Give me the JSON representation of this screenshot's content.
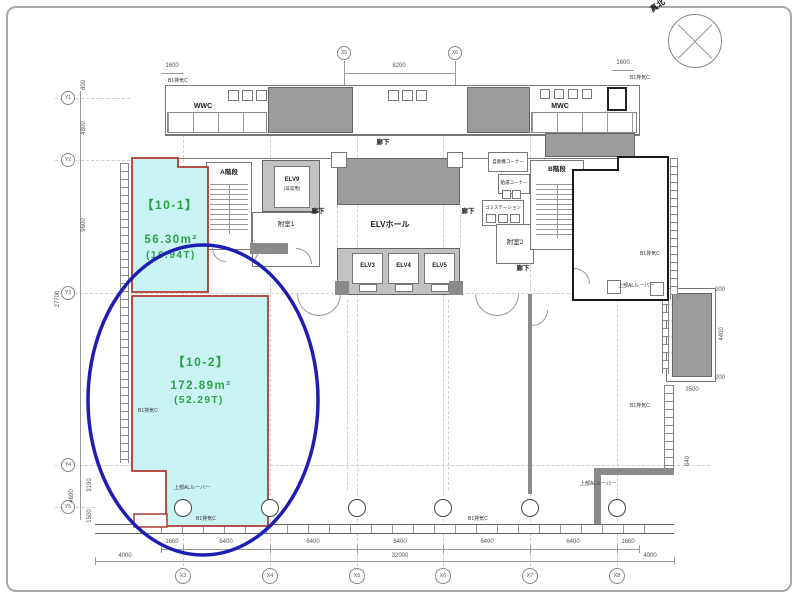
{
  "compass": {
    "label": "真北"
  },
  "units": {
    "u101": {
      "name": "【10-1】",
      "area": "56.30m²",
      "tsubo": "(16.94T)"
    },
    "u102": {
      "name": "【10-2】",
      "area": "172.89m²",
      "tsubo": "(52.29T)"
    }
  },
  "rooms": {
    "stair_a": "A階段",
    "stair_b": "B階段",
    "elv9": "ELV9",
    "elv9_note": "(非常用)",
    "elv3": "ELV3",
    "elv4": "ELV4",
    "elv5": "ELV5",
    "elv_hall": "ELVホール",
    "corridor": "廊下",
    "anteroom1": "附室1",
    "anteroom2": "附室2",
    "wwc": "WWC",
    "mwc": "MWC",
    "garbage": "ゴミステーション",
    "vending": "自販機コーナー",
    "hotwater": "給湯コーナー"
  },
  "annotations": {
    "exhaust": "B1排気C",
    "louver": "上部ALルーバー"
  },
  "grid": {
    "bottom": [
      "X3",
      "X4",
      "X5",
      "X6",
      "X7",
      "X8"
    ],
    "top": [
      "X5",
      "X6"
    ],
    "left": [
      "Y1",
      "Y2",
      "Y3",
      "Y4",
      "Y5"
    ]
  },
  "dims": {
    "top_left": "1600",
    "top_span": "8200",
    "top_right": "1600",
    "bottom_row": [
      "1600",
      "6400",
      "6400",
      "6400",
      "6400",
      "6400",
      "1600"
    ],
    "bottom_left_total": "4000",
    "bottom_total": "32000",
    "bottom_right_total": "4000",
    "left": [
      "800",
      "4800",
      "9600",
      "27700",
      "3190",
      "1500",
      "4690"
    ],
    "right": [
      "200",
      "4400",
      "200",
      "3500",
      "640"
    ]
  },
  "colors": {
    "unit_fill": "#c9f4f3",
    "unit_border": "#b03a30",
    "tenant_border": "#1a1a1a",
    "highlight": "#1e1eb4",
    "label_green": "#2da04a"
  }
}
